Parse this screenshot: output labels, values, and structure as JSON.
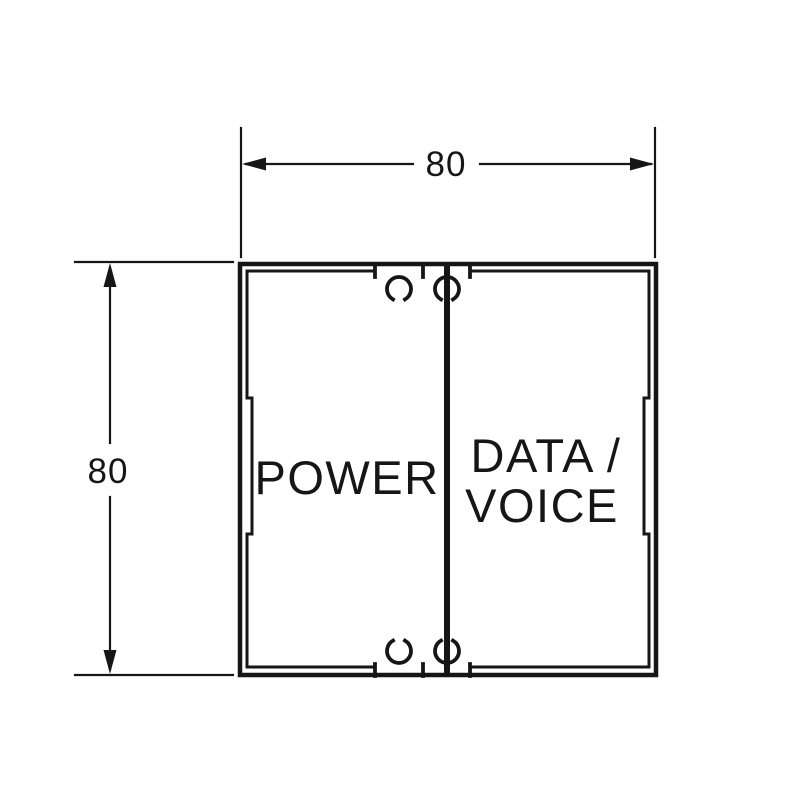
{
  "drawing": {
    "background_color": "#ffffff",
    "line_color": "#161616",
    "width_dimension": {
      "value": "80"
    },
    "height_dimension": {
      "value": "80"
    },
    "left_compartment_label": "POWER",
    "right_compartment_label_line1": "DATA /",
    "right_compartment_label_line2": "VOICE"
  }
}
